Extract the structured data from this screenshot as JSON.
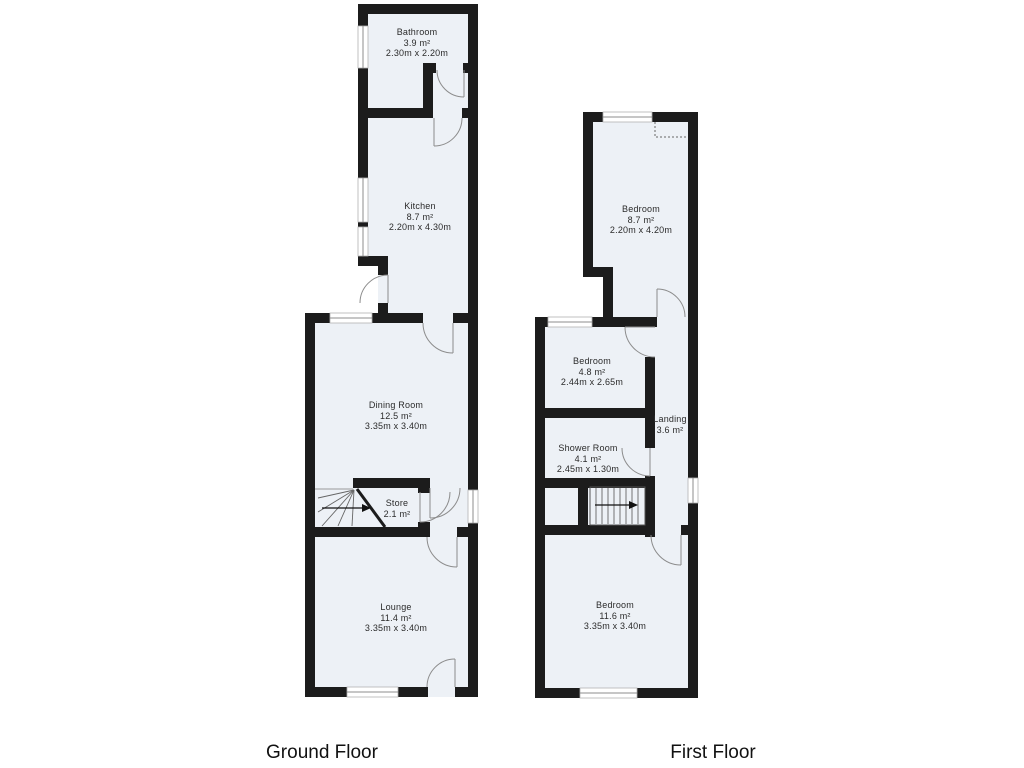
{
  "colors": {
    "wall": "#1c1c1c",
    "room_fill": "#edf1f6",
    "line": "#8c8c8c"
  },
  "floors": [
    {
      "caption": "Ground Floor",
      "rooms": [
        {
          "name": "Bathroom",
          "area": "3.9 m²",
          "dims": "2.30m x 2.20m"
        },
        {
          "name": "Kitchen",
          "area": "8.7 m²",
          "dims": "2.20m x 4.30m"
        },
        {
          "name": "Dining Room",
          "area": "12.5 m²",
          "dims": "3.35m x 3.40m"
        },
        {
          "name": "Store",
          "area": "2.1 m²"
        },
        {
          "name": "Lounge",
          "area": "11.4 m²",
          "dims": "3.35m x 3.40m"
        }
      ]
    },
    {
      "caption": "First Floor",
      "rooms": [
        {
          "name": "Bedroom",
          "area": "8.7 m²",
          "dims": "2.20m x 4.20m"
        },
        {
          "name": "Bedroom",
          "area": "4.8 m²",
          "dims": "2.44m x 2.65m"
        },
        {
          "name": "Landing",
          "area": "3.6 m²"
        },
        {
          "name": "Shower Room",
          "area": "4.1 m²",
          "dims": "2.45m x 1.30m"
        },
        {
          "name": "Bedroom",
          "area": "11.6 m²",
          "dims": "3.35m x 3.40m"
        }
      ]
    }
  ]
}
